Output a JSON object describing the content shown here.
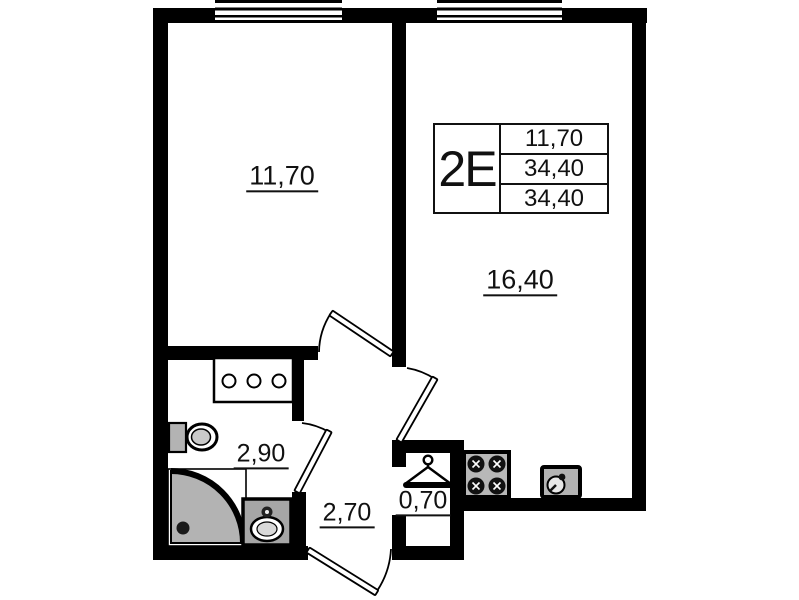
{
  "unit_card": {
    "type_label": "2Е",
    "area_values": [
      "11,70",
      "34,40",
      "34,40"
    ]
  },
  "room_labels": {
    "bedroom": "11,70",
    "kitchen_living": "16,40",
    "bathroom": "2,90",
    "hallway": "2,70",
    "closet": "0,70"
  },
  "fixtures": [
    "window",
    "toilet",
    "shower-cabin",
    "washbasin",
    "vanity-cabinet",
    "stove",
    "kitchen-sink",
    "clothes-hanger",
    "door-swing"
  ],
  "colors": {
    "wall": "#000000",
    "background": "#ffffff",
    "fixture_fill": "#b3b3b3"
  }
}
